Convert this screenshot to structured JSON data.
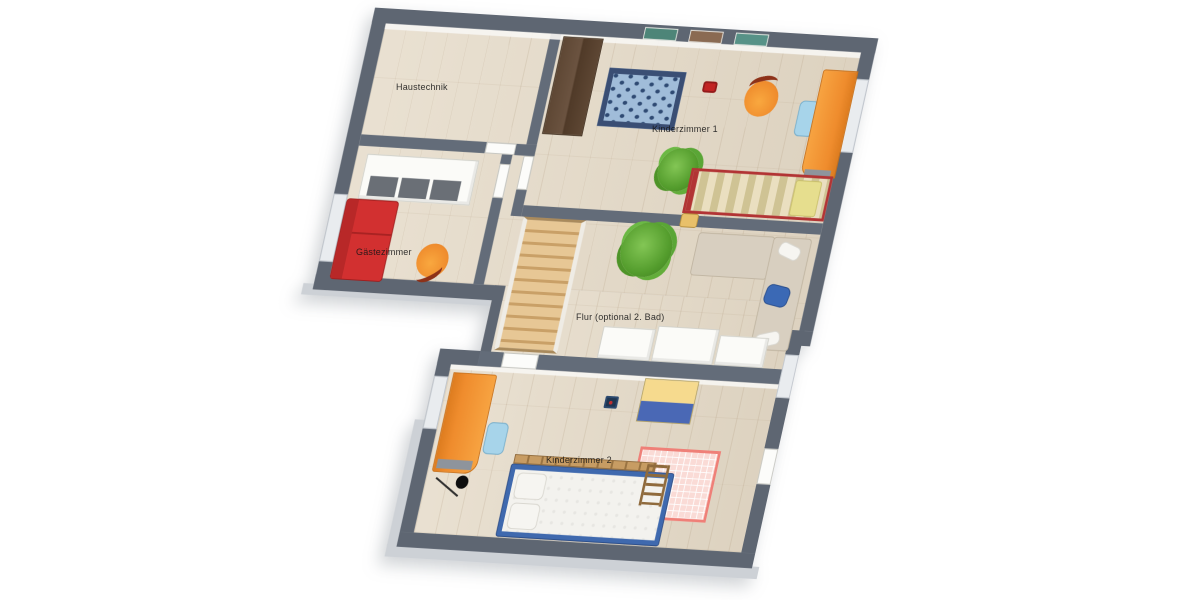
{
  "floorplan": {
    "type": "3d-floor-plan",
    "background": "#ffffff",
    "colors": {
      "exterior_wall": "#5e6672",
      "interior_wall": "#636c79",
      "foundation_skirt": "#cdd1d6",
      "floor_wood": "#e4d9c6",
      "door_leaf": "#fcfcfa",
      "window": "#e9ecef",
      "accent_orange": "#ef8c2d",
      "accent_red": "#d23030",
      "accent_blue": "#3f69ae",
      "rug_blue": "#a0bcd9",
      "rug_pink": "#fadbd6",
      "plant_green": "#539c2c",
      "stairs_wood": "#e0bd8a"
    },
    "rooms": [
      {
        "id": "haustechnik",
        "label": "Haustechnik",
        "furniture": []
      },
      {
        "id": "kinderzimmer-1",
        "label": "Kinderzimmer 1",
        "furniture": [
          "wardrobe-brown",
          "wall-pictures",
          "star-rug-blue",
          "toy-car-red",
          "lounge-chair-orange",
          "desk-chair-blue",
          "desk-orange",
          "plant",
          "bed-single-striped-red-frame"
        ]
      },
      {
        "id": "gaestezimmer",
        "label": "Gästezimmer",
        "furniture": [
          "wardrobe-white-3-doors",
          "sofa-bed-red",
          "lounge-chair-orange"
        ]
      },
      {
        "id": "flur",
        "label": "Flur (optional 2. Bad)",
        "furniture": [
          "staircase-wood",
          "plant-large",
          "toy-car-yellow",
          "corner-sofa-beige",
          "pillow-white",
          "pillow-blue",
          "pillow-white",
          "sideboard-white",
          "sideboard-white",
          "sideboard-white"
        ]
      },
      {
        "id": "kinderzimmer-2",
        "label": "Kinderzimmer 2",
        "furniture": [
          "desk-orange",
          "desk-chair-blue",
          "floor-lamp-black",
          "toy-box-navy",
          "toy-chest-yellow-blue",
          "play-rug-pink-grid",
          "bed-single-blue-frame",
          "bunk-rail-wood",
          "ladder-wood"
        ]
      }
    ]
  }
}
